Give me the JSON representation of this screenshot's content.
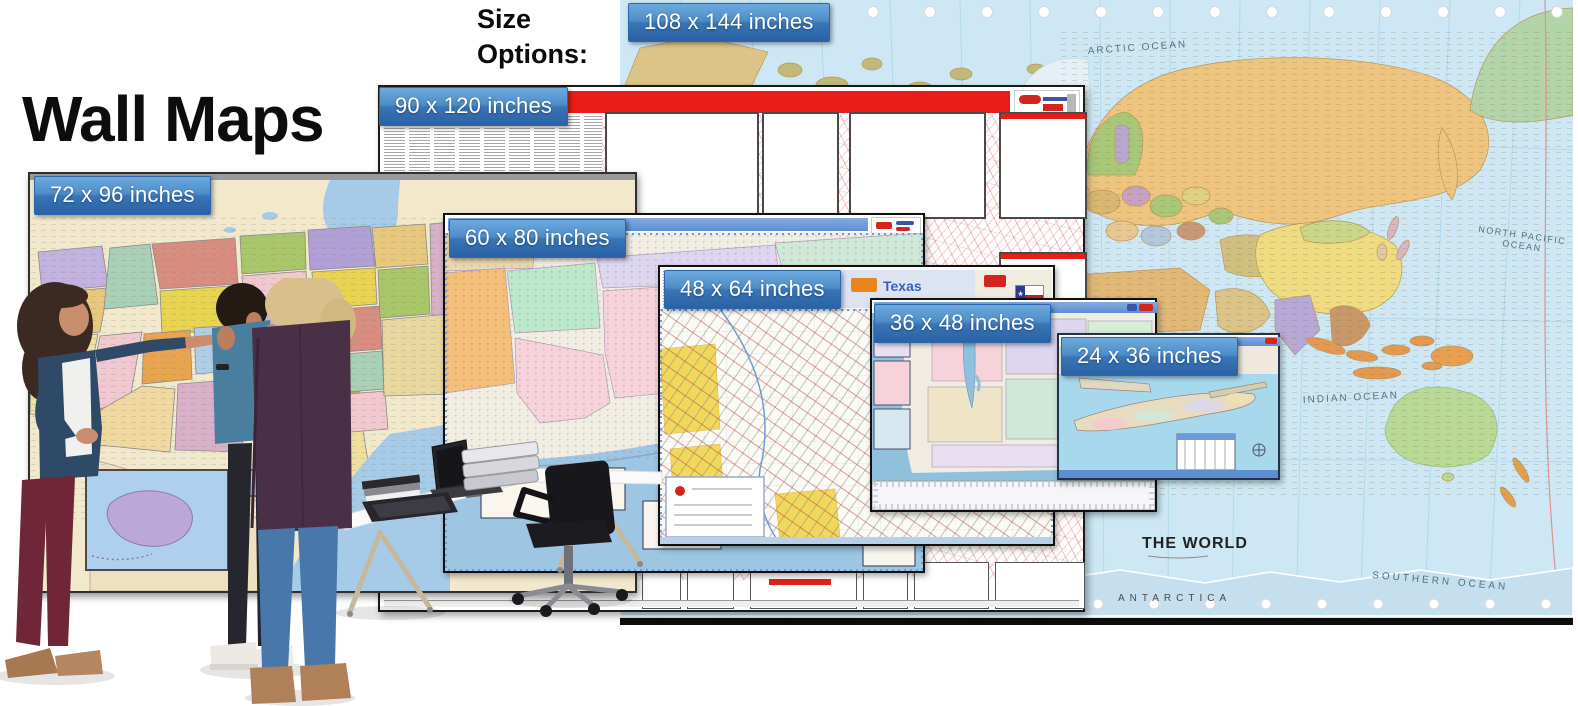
{
  "banner": {
    "title": "Wall Maps",
    "size_options_heading": "Size Options:"
  },
  "size_options": [
    {
      "label": "108 x 144 inches"
    },
    {
      "label": "90 x 120 inches"
    },
    {
      "label": "72 x 96 inches"
    },
    {
      "label": "60 x 80 inches"
    },
    {
      "label": "48 x 64 inches"
    },
    {
      "label": "36 x 48 inches"
    },
    {
      "label": "24 x 36 inches"
    }
  ],
  "world_map": {
    "title": "THE WORLD",
    "antarctica_label": "ANTARCTICA",
    "ocean_labels": {
      "arctic": "ARCTIC OCEAN",
      "north_pacific_line1": "NORTH PACIFIC",
      "north_pacific_line2": "OCEAN",
      "indian": "INDIAN OCEAN",
      "southern": "SOUTHERN OCEAN"
    }
  },
  "texas_map": {
    "title": "Texas"
  },
  "colors": {
    "chip_blue_top": "#6caade",
    "chip_blue_bottom": "#2b62a6",
    "zip_banner_red": "#ea1c18",
    "map_banner_blue": "#5d8ed2",
    "ocean_blue": "#cde8f4",
    "title_black": "#0d0d0d"
  }
}
